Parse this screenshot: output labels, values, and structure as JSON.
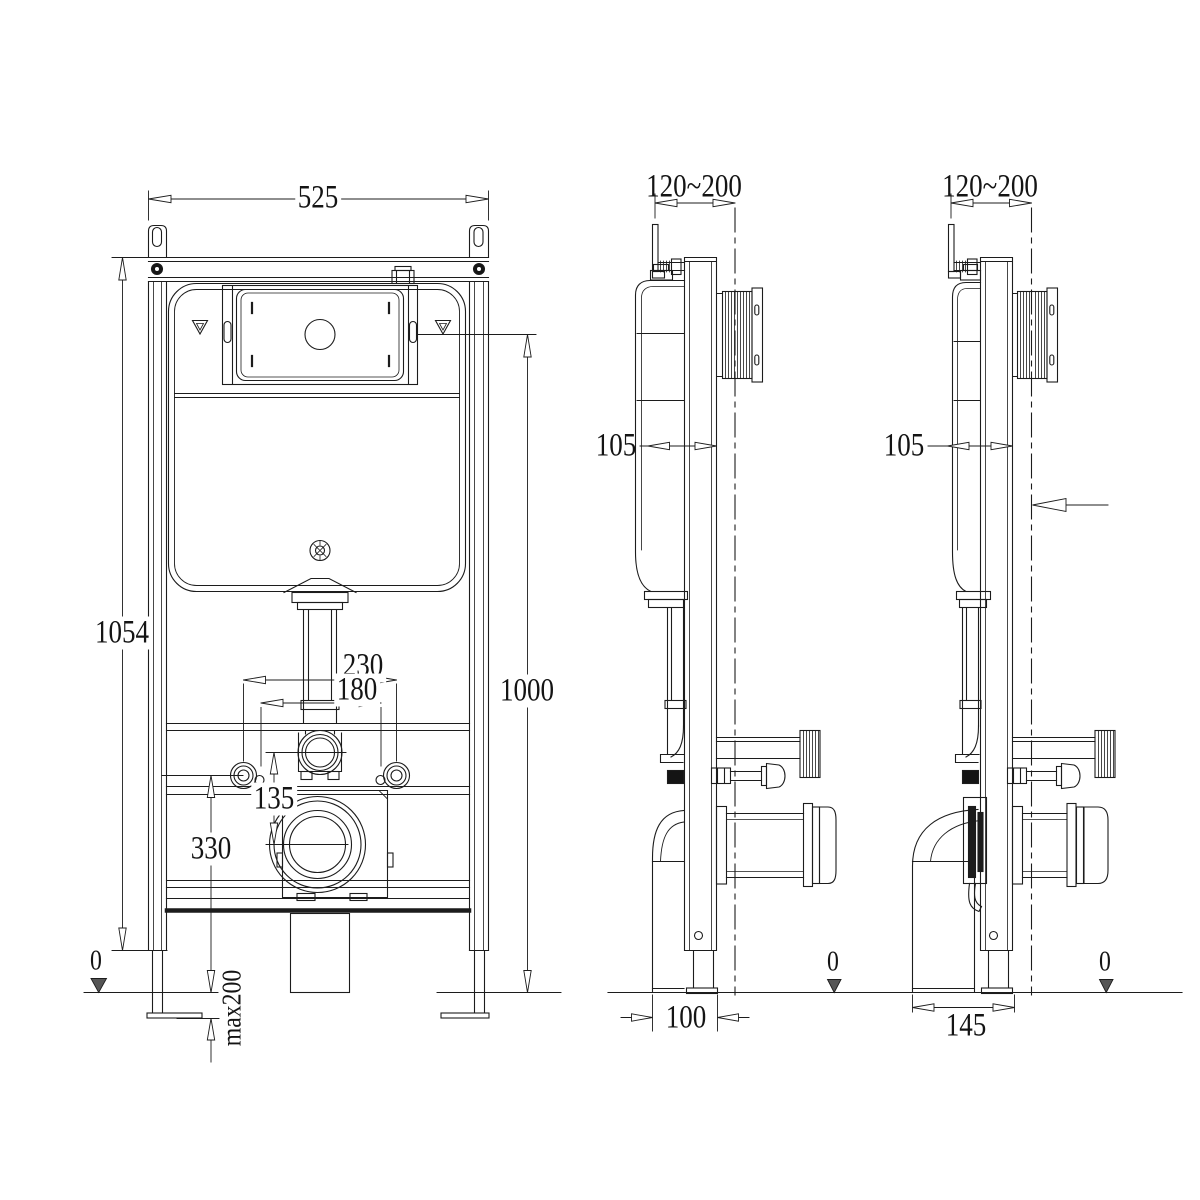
{
  "front": {
    "width": "525",
    "frame_height": "1054",
    "panel_height": "1000",
    "fixing_outer": "230",
    "fixing_inner": "180",
    "flush_to_outlet": "135",
    "outlet_height": "330",
    "floor_level": "0",
    "foot_adjust": "max200"
  },
  "side_center": {
    "wall_thickness": "120~200",
    "frame_depth": "105",
    "outlet_distance": "100",
    "floor_level": "0"
  },
  "side_right": {
    "wall_thickness": "120~200",
    "frame_depth": "105",
    "outlet_distance": "145",
    "floor_level": "0"
  }
}
